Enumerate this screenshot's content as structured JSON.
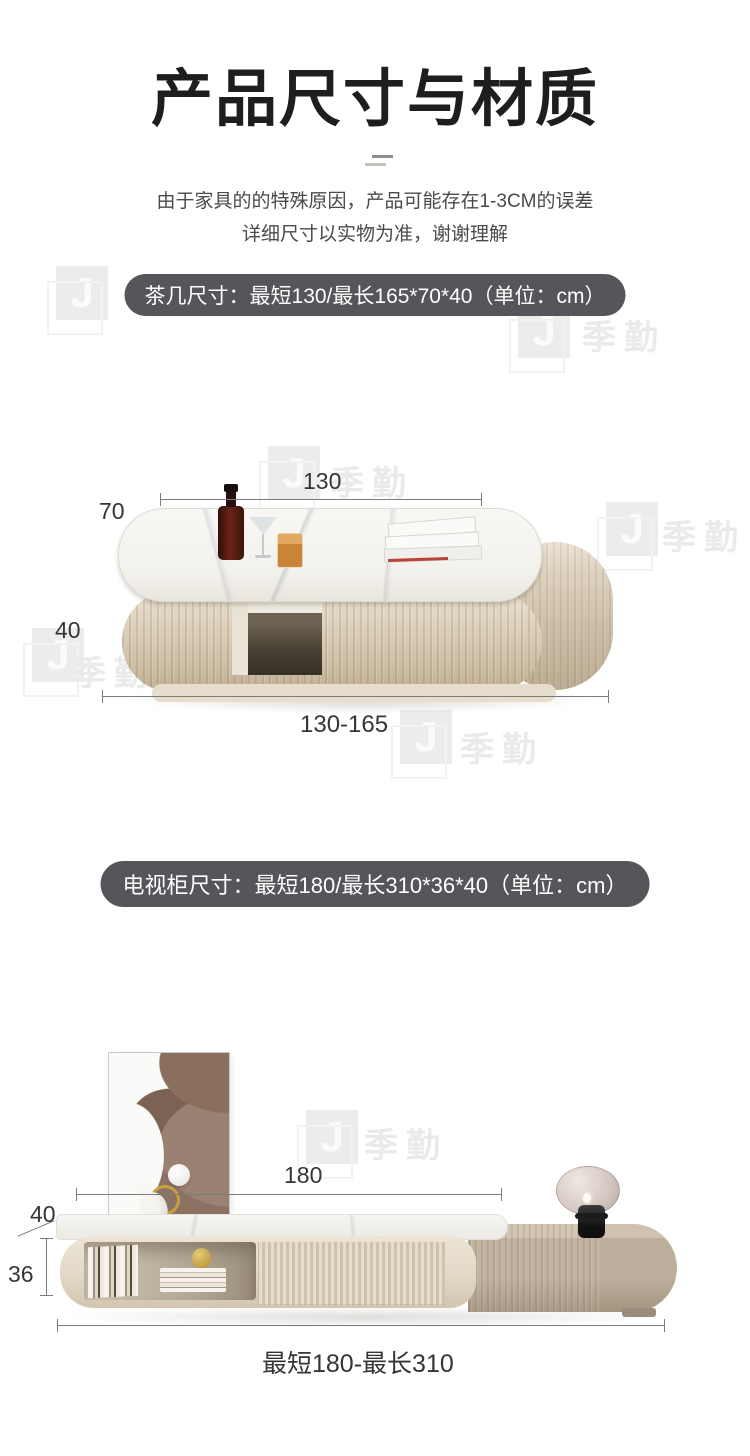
{
  "page": {
    "title": "产品尺寸与材质",
    "disclaimer_line1": "由于家具的的特殊原因，产品可能存在1-3CM的误差",
    "disclaimer_line2": "详细尺寸以实物为准，谢谢理解"
  },
  "colors": {
    "pill_bg": "#55565a",
    "dim_line": "#7b7b7b",
    "title_text": "#1e1e1e",
    "cream_wood": "#e2d8c7",
    "greige_wood": "#c2b3a1",
    "marble": "#f6f5f2"
  },
  "watermark": {
    "logo_letter": "J",
    "brand": "季勤"
  },
  "coffee_table": {
    "banner": "茶几尺寸：最短130/最长165*70*40（单位：cm）",
    "dims": {
      "width": "130",
      "depth": "70",
      "height": "40",
      "range": "130-165"
    }
  },
  "tv_stand": {
    "banner": "电视柜尺寸：最短180/最长310*36*40（单位：cm）",
    "dims": {
      "width": "180",
      "depth": "40",
      "height": "36",
      "range": "最短180-最长310"
    }
  }
}
